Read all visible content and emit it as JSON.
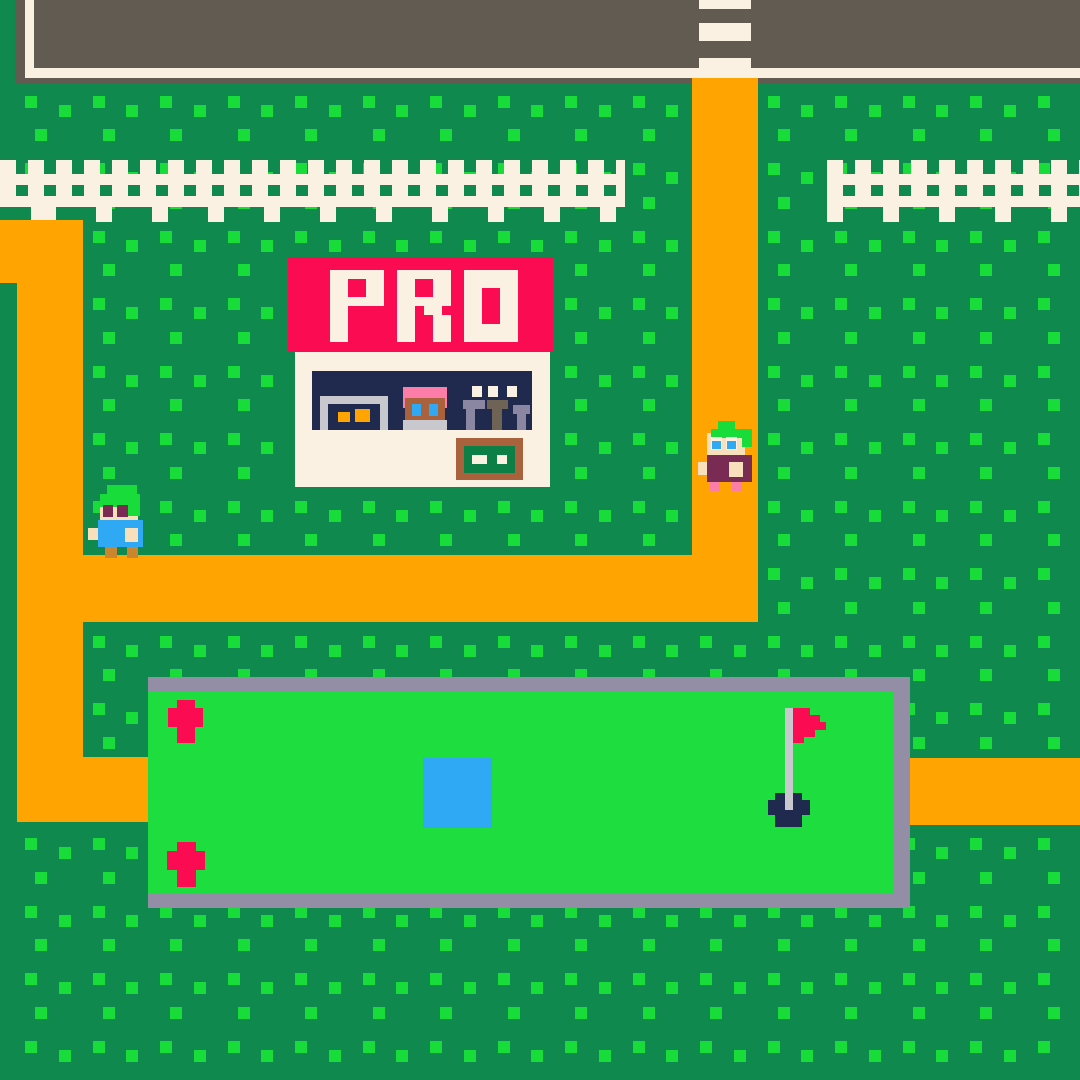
{
  "sign": {
    "text": "PRO"
  },
  "palette": {
    "grass": "#10894F",
    "dot": "#17DC3A",
    "brightGreen": "#1EDD3F",
    "hairGreen": "#17DC3A",
    "orange": "#FFA400",
    "road": "#615B52",
    "cream": "#FAF1E3",
    "red": "#FB0B52",
    "navy": "#20294E",
    "grayBorder": "#938EA6",
    "lightGray": "#C9C8CE",
    "brown": "#A9623C",
    "signGreen": "#0C7F47",
    "skin": "#F7E0BB",
    "maroon": "#7A2B54",
    "pink": "#FC7DA8",
    "blue": "#2FA9F3",
    "legTan": "#C9862F",
    "shelfPurple": "#8B86A2",
    "shelfTaupe": "#6F6355"
  },
  "dots": {
    "rows": 32,
    "cols": 31,
    "spacing": 33.75,
    "size": 12,
    "even_x_offset": 25,
    "odd_x_offset": 35,
    "y_offset": 28,
    "stagger": 9
  },
  "fence": {
    "metrics": {
      "post_w": 16,
      "gap": 12,
      "post_h": 47,
      "rail1_y": 14,
      "rail2_y": 36,
      "rail_h": 11,
      "long_y": 45,
      "long_h": 17,
      "long_period": 56
    },
    "segments": [
      {
        "name": "fence-left",
        "x": 0,
        "y": 160,
        "w": 625,
        "h": 62,
        "long_shift": 40
      },
      {
        "name": "fence-right",
        "x": 827,
        "y": 160,
        "w": 253,
        "h": 62,
        "long_shift": 0
      }
    ]
  },
  "sign_layout": {
    "x": 330,
    "y": 270,
    "cell": 9,
    "advance": 67
  },
  "layers": {
    "under": [
      {
        "name": "road-surface",
        "x": 15,
        "y": 0,
        "w": 1065,
        "h": 84,
        "c": "road"
      },
      {
        "name": "road-curb-left",
        "x": 25,
        "y": 0,
        "w": 9,
        "h": 78,
        "c": "cream"
      },
      {
        "name": "road-curb-bottom",
        "x": 25,
        "y": 68,
        "w": 1055,
        "h": 10,
        "c": "cream"
      },
      {
        "name": "crosswalk-stripe",
        "x": 699,
        "y": 0,
        "w": 52,
        "h": 9,
        "c": "cream"
      },
      {
        "name": "crosswalk-stripe",
        "x": 699,
        "y": 23,
        "w": 52,
        "h": 18,
        "c": "cream"
      },
      {
        "name": "crosswalk-stripe",
        "x": 699,
        "y": 58,
        "w": 52,
        "h": 20,
        "c": "cream"
      }
    ],
    "main": [
      {
        "name": "path-center-vertical",
        "x": 692,
        "y": 78,
        "w": 66,
        "h": 544,
        "c": "orange"
      },
      {
        "name": "path-horizontal-band",
        "x": 83,
        "y": 555,
        "w": 675,
        "h": 67,
        "c": "orange"
      },
      {
        "name": "path-left-top",
        "x": 0,
        "y": 220,
        "w": 83,
        "h": 63,
        "c": "orange"
      },
      {
        "name": "path-left-vertical",
        "x": 17,
        "y": 220,
        "w": 66,
        "h": 602,
        "c": "orange"
      },
      {
        "name": "path-golf-connector",
        "x": 83,
        "y": 757,
        "w": 67,
        "h": 65,
        "c": "orange"
      },
      {
        "name": "path-right-band",
        "x": 910,
        "y": 758,
        "w": 170,
        "h": 67,
        "c": "orange"
      },
      {
        "name": "golf-green-frame",
        "x": 148,
        "y": 677,
        "w": 762,
        "h": 231,
        "c": "grayBorder"
      },
      {
        "name": "golf-green-field",
        "x": 148,
        "y": 691,
        "w": 745,
        "h": 202,
        "c": "brightGreen"
      },
      {
        "name": "flower",
        "x": 177,
        "y": 700,
        "w": 18,
        "h": 43,
        "c": "red"
      },
      {
        "name": "flower",
        "x": 168,
        "y": 708,
        "w": 35,
        "h": 19,
        "c": "red"
      },
      {
        "name": "flower",
        "x": 177,
        "y": 842,
        "w": 19,
        "h": 45,
        "c": "red"
      },
      {
        "name": "flower",
        "x": 167,
        "y": 851,
        "w": 38,
        "h": 19,
        "c": "red"
      },
      {
        "name": "water-hazard",
        "x": 423,
        "y": 758,
        "w": 69,
        "h": 70,
        "c": "blue"
      },
      {
        "name": "golf-hole",
        "x": 775,
        "y": 793,
        "w": 27,
        "h": 34,
        "c": "navy"
      },
      {
        "name": "golf-hole",
        "x": 768,
        "y": 800,
        "w": 42,
        "h": 15,
        "c": "navy"
      },
      {
        "name": "flag-pole",
        "x": 785,
        "y": 708,
        "w": 8,
        "h": 102,
        "c": "lightGray"
      },
      {
        "name": "flag",
        "x": 793,
        "y": 708,
        "w": 17,
        "h": 7,
        "c": "red"
      },
      {
        "name": "flag",
        "x": 793,
        "y": 715,
        "w": 27,
        "h": 7,
        "c": "red"
      },
      {
        "name": "flag",
        "x": 793,
        "y": 722,
        "w": 33,
        "h": 8,
        "c": "red"
      },
      {
        "name": "flag",
        "x": 793,
        "y": 730,
        "w": 22,
        "h": 7,
        "c": "red"
      },
      {
        "name": "flag",
        "x": 793,
        "y": 737,
        "w": 11,
        "h": 6,
        "c": "red"
      },
      {
        "name": "shop-sign",
        "x": 288,
        "y": 257,
        "w": 265,
        "h": 95,
        "c": "red"
      },
      {
        "name": "shop-building",
        "x": 295,
        "y": 352,
        "w": 255,
        "h": 135,
        "c": "cream"
      },
      {
        "name": "shop-window-band",
        "x": 312,
        "y": 371,
        "w": 220,
        "h": 59,
        "c": "navy"
      },
      {
        "name": "window-frame",
        "x": 320,
        "y": 396,
        "w": 68,
        "h": 8,
        "c": "lightGray"
      },
      {
        "name": "window-frame",
        "x": 320,
        "y": 396,
        "w": 8,
        "h": 34,
        "c": "lightGray"
      },
      {
        "name": "window-frame",
        "x": 380,
        "y": 396,
        "w": 8,
        "h": 34,
        "c": "lightGray"
      },
      {
        "name": "window-item",
        "x": 338,
        "y": 412,
        "w": 12,
        "h": 10,
        "c": "orange"
      },
      {
        "name": "window-item",
        "x": 355,
        "y": 409,
        "w": 15,
        "h": 13,
        "c": "orange"
      },
      {
        "name": "shopkeeper-hair",
        "x": 403,
        "y": 387,
        "w": 44,
        "h": 21,
        "c": "pink"
      },
      {
        "name": "shopkeeper-face",
        "x": 405,
        "y": 398,
        "w": 40,
        "h": 24,
        "c": "brown"
      },
      {
        "name": "shopkeeper-eye",
        "x": 412,
        "y": 404,
        "w": 9,
        "h": 12,
        "c": "blue"
      },
      {
        "name": "shopkeeper-eye",
        "x": 429,
        "y": 404,
        "w": 9,
        "h": 12,
        "c": "blue"
      },
      {
        "name": "shopkeeper-shirt",
        "x": 403,
        "y": 420,
        "w": 44,
        "h": 10,
        "c": "lightGray"
      },
      {
        "name": "shop-light",
        "x": 472,
        "y": 386,
        "w": 10,
        "h": 11,
        "c": "cream"
      },
      {
        "name": "shop-light",
        "x": 488,
        "y": 386,
        "w": 10,
        "h": 11,
        "c": "cream"
      },
      {
        "name": "shop-light",
        "x": 507,
        "y": 386,
        "w": 10,
        "h": 11,
        "c": "cream"
      },
      {
        "name": "shelf-item",
        "x": 463,
        "y": 400,
        "w": 22,
        "h": 9,
        "c": "shelfPurple"
      },
      {
        "name": "shelf-item",
        "x": 466,
        "y": 409,
        "w": 9,
        "h": 21,
        "c": "shelfPurple"
      },
      {
        "name": "shelf-item",
        "x": 487,
        "y": 400,
        "w": 21,
        "h": 9,
        "c": "shelfTaupe"
      },
      {
        "name": "shelf-item",
        "x": 492,
        "y": 409,
        "w": 10,
        "h": 21,
        "c": "shelfTaupe"
      },
      {
        "name": "shelf-item",
        "x": 513,
        "y": 405,
        "w": 17,
        "h": 9,
        "c": "shelfPurple"
      },
      {
        "name": "shelf-item",
        "x": 517,
        "y": 414,
        "w": 9,
        "h": 16,
        "c": "shelfPurple"
      },
      {
        "name": "shop-signboard",
        "x": 456,
        "y": 438,
        "w": 67,
        "h": 42,
        "c": "brown"
      },
      {
        "name": "shop-signboard-inner",
        "x": 464,
        "y": 446,
        "w": 51,
        "h": 27,
        "c": "signGreen"
      },
      {
        "name": "signboard-dash",
        "x": 472,
        "y": 455,
        "w": 15,
        "h": 9,
        "c": "cream"
      },
      {
        "name": "signboard-dash",
        "x": 497,
        "y": 455,
        "w": 10,
        "h": 9,
        "c": "cream"
      },
      {
        "name": "golfer-blue-face",
        "x": 100,
        "y": 497,
        "w": 38,
        "h": 23,
        "c": "skin",
        "i": true
      },
      {
        "name": "golfer-blue-hair",
        "x": 107,
        "y": 485,
        "w": 30,
        "h": 12,
        "c": "hairGreen",
        "i": true
      },
      {
        "name": "golfer-blue-hair",
        "x": 100,
        "y": 494,
        "w": 40,
        "h": 13,
        "c": "hairGreen",
        "i": true
      },
      {
        "name": "golfer-blue-hair",
        "x": 128,
        "y": 505,
        "w": 12,
        "h": 11,
        "c": "hairGreen",
        "i": true
      },
      {
        "name": "golfer-blue-eye",
        "x": 103,
        "y": 505,
        "w": 10,
        "h": 12,
        "c": "maroon",
        "i": true
      },
      {
        "name": "golfer-blue-eye",
        "x": 117,
        "y": 505,
        "w": 11,
        "h": 12,
        "c": "maroon",
        "i": true
      },
      {
        "name": "golfer-blue-shirt",
        "x": 98,
        "y": 520,
        "w": 45,
        "h": 27,
        "c": "blue",
        "i": true
      },
      {
        "name": "golfer-blue-arm",
        "x": 88,
        "y": 528,
        "w": 10,
        "h": 12,
        "c": "skin",
        "i": true
      },
      {
        "name": "golfer-blue-hand",
        "x": 125,
        "y": 528,
        "w": 13,
        "h": 14,
        "c": "skin",
        "i": true
      },
      {
        "name": "golfer-blue-leg",
        "x": 105,
        "y": 547,
        "w": 12,
        "h": 11,
        "c": "legTan",
        "i": true
      },
      {
        "name": "golfer-blue-leg",
        "x": 127,
        "y": 547,
        "w": 11,
        "h": 11,
        "c": "legTan",
        "i": true
      },
      {
        "name": "golfer-maroon-face",
        "x": 707,
        "y": 433,
        "w": 38,
        "h": 23,
        "c": "skin",
        "i": true
      },
      {
        "name": "golfer-maroon-hair",
        "x": 718,
        "y": 421,
        "w": 17,
        "h": 10,
        "c": "hairGreen",
        "i": true
      },
      {
        "name": "golfer-maroon-hair",
        "x": 711,
        "y": 429,
        "w": 41,
        "h": 9,
        "c": "hairGreen",
        "i": true
      },
      {
        "name": "golfer-maroon-hair",
        "x": 742,
        "y": 432,
        "w": 10,
        "h": 15,
        "c": "hairGreen",
        "i": true
      },
      {
        "name": "golfer-maroon-eye",
        "x": 711,
        "y": 437,
        "w": 11,
        "h": 13,
        "c": "cream",
        "i": true
      },
      {
        "name": "golfer-maroon-eye",
        "x": 726,
        "y": 437,
        "w": 11,
        "h": 13,
        "c": "cream",
        "i": true
      },
      {
        "name": "golfer-maroon-pupil",
        "x": 712,
        "y": 441,
        "w": 9,
        "h": 8,
        "c": "blue",
        "i": true
      },
      {
        "name": "golfer-maroon-pupil",
        "x": 727,
        "y": 441,
        "w": 9,
        "h": 8,
        "c": "blue",
        "i": true
      },
      {
        "name": "golfer-maroon-body",
        "x": 707,
        "y": 455,
        "w": 45,
        "h": 27,
        "c": "maroon",
        "i": true
      },
      {
        "name": "golfer-maroon-arm",
        "x": 698,
        "y": 462,
        "w": 9,
        "h": 13,
        "c": "skin",
        "i": true
      },
      {
        "name": "golfer-maroon-hand",
        "x": 729,
        "y": 462,
        "w": 14,
        "h": 15,
        "c": "skin",
        "i": true
      },
      {
        "name": "golfer-maroon-leg",
        "x": 710,
        "y": 482,
        "w": 10,
        "h": 9,
        "c": "pink",
        "i": true
      },
      {
        "name": "golfer-maroon-leg",
        "x": 732,
        "y": 482,
        "w": 10,
        "h": 9,
        "c": "pink",
        "i": true
      }
    ]
  }
}
